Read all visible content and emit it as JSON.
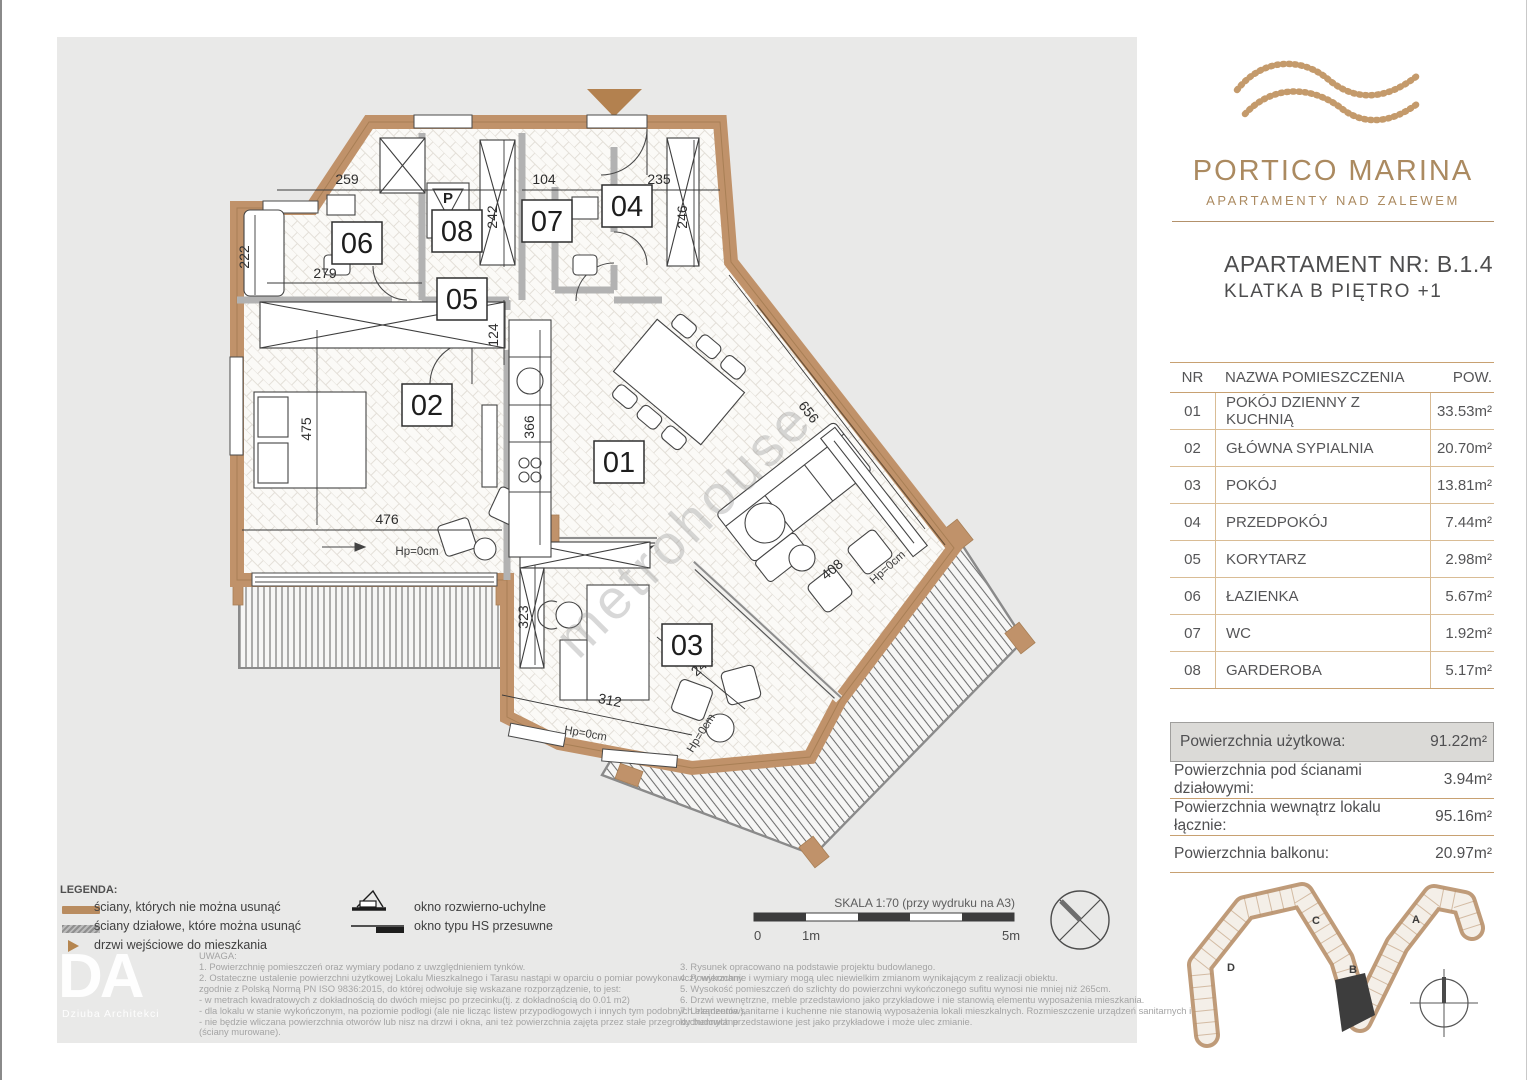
{
  "colors": {
    "accent": "#ae8c62",
    "wall": "#c0926a",
    "highlight_bg": "#dbdad7"
  },
  "brand": {
    "name": "PORTICO MARINA",
    "tagline": "APARTAMENTY NAD ZALEWEM"
  },
  "apartment": {
    "line1": "APARTAMENT NR: B.1.4",
    "line2": "KLATKA B PIĘTRO +1"
  },
  "rooms_table": {
    "headers": {
      "nr": "NR",
      "name": "NAZWA POMIESZCZENIA",
      "area": "POW."
    },
    "rows": [
      {
        "nr": "01",
        "name": "POKÓJ DZIENNY Z KUCHNIĄ",
        "area": "33.53m²"
      },
      {
        "nr": "02",
        "name": "GŁÓWNA SYPIALNIA",
        "area": "20.70m²"
      },
      {
        "nr": "03",
        "name": "POKÓJ",
        "area": "13.81m²"
      },
      {
        "nr": "04",
        "name": "PRZEDPOKÓJ",
        "area": "7.44m²"
      },
      {
        "nr": "05",
        "name": "KORYTARZ",
        "area": "2.98m²"
      },
      {
        "nr": "06",
        "name": "ŁAZIENKA",
        "area": "5.67m²"
      },
      {
        "nr": "07",
        "name": "WC",
        "area": "1.92m²"
      },
      {
        "nr": "08",
        "name": "GARDEROBA",
        "area": "5.17m²"
      }
    ]
  },
  "summary": {
    "r1": {
      "label": "Powierzchnia użytkowa:",
      "value": "91.22m²"
    },
    "r2": {
      "label": "Powierzchnia pod ścianami działowymi:",
      "value": "3.94m²"
    },
    "r3": {
      "label": "Powierzchnia wewnątrz lokalu łącznie:",
      "value": "95.16m²"
    },
    "r4": {
      "label": "Powierzchnia balkonu:",
      "value": "20.97m²"
    }
  },
  "legend": {
    "title": "LEGENDA:",
    "wall_fixed": "ściany, których nie można usunąć",
    "wall_partition": "ściany działowe, które można usunąć",
    "entrance": "drzwi wejściowe do mieszkania",
    "window_tilt": "okno rozwierno-uchylne",
    "window_hs": "okno typu HS przesuwne"
  },
  "notes": {
    "title": "UWAGA:",
    "col1": [
      "1. Powierzchnię pomieszczeń oraz wymiary podano z uwzględnieniem tynków.",
      "2. Ostateczne ustalenie powierzchni użytkowej Lokalu Mieszkalnego i Tarasu nastąpi w oparciu o pomiar powykonawczy wykonany",
      "zgodnie z Polską Normą PN ISO 9836:2015, do której odwołuje się wskazane rozporządzenie, to jest:",
      "- w metrach kwadratowych z dokładnością do dwóch miejsc po przecinku(tj. z dokładnością do 0.01 m2)",
      "- dla lokalu w stanie wykończonym, na poziomie podłogi (ale nie licząc listew przypodłogowych i innych tym podobnych elementów),",
      "- nie będzie wliczana powierzchnia otworów lub nisz na drzwi i okna, ani też powierzchnia zajęta przez stałe przegrody budowlane",
      "(ściany murowane)."
    ],
    "col2": [
      "3. Rysunek opracowano na podstawie projektu budowlanego.",
      "4. Powierzchnie i wymiary mogą ulec niewielkim zmianom wynikającym z realizacji obiektu.",
      "5. Wysokość pomieszczeń do szlichty do powierzchni wykończonego sufitu wynosi nie mniej niż 265cm.",
      "6. Drzwi wewnętrzne, meble przedstawiono jako przykładowe i nie stanowią elementu wyposażenia mieszkania.",
      "7. Urządzenia sanitarne i kuchenne nie stanowią wyposażenia lokali mieszkalnych. Rozmieszczenie urządzeń sanitarnych i",
      "kuchennych przedstawione jest jako przykładowe i może ulec zmianie."
    ]
  },
  "scale": {
    "label": "SKALA 1:70 (przy wydruku na A3)",
    "t0": "0",
    "t1": "1m",
    "t5": "5m"
  },
  "plan": {
    "watermark": "metrohouse",
    "washer": "P",
    "hp": "Hp=0cm",
    "labels": {
      "r01": "01",
      "r02": "02",
      "r03": "03",
      "r04": "04",
      "r05": "05",
      "r06": "06",
      "r07": "07",
      "r08": "08"
    },
    "dims": {
      "d259": "259",
      "d104": "104",
      "d235": "235",
      "d242": "242",
      "d246": "246",
      "d222": "222",
      "d279": "279",
      "d124": "124",
      "d475": "475",
      "d476": "476",
      "d366": "366",
      "d656": "656",
      "d323": "323",
      "d312": "312",
      "d241": "241",
      "d408": "408"
    }
  },
  "site_map": {
    "a": "A",
    "b": "B",
    "c": "C",
    "d": "D"
  },
  "architect": {
    "initials": "DA",
    "name": "Dziuba Architekci"
  }
}
